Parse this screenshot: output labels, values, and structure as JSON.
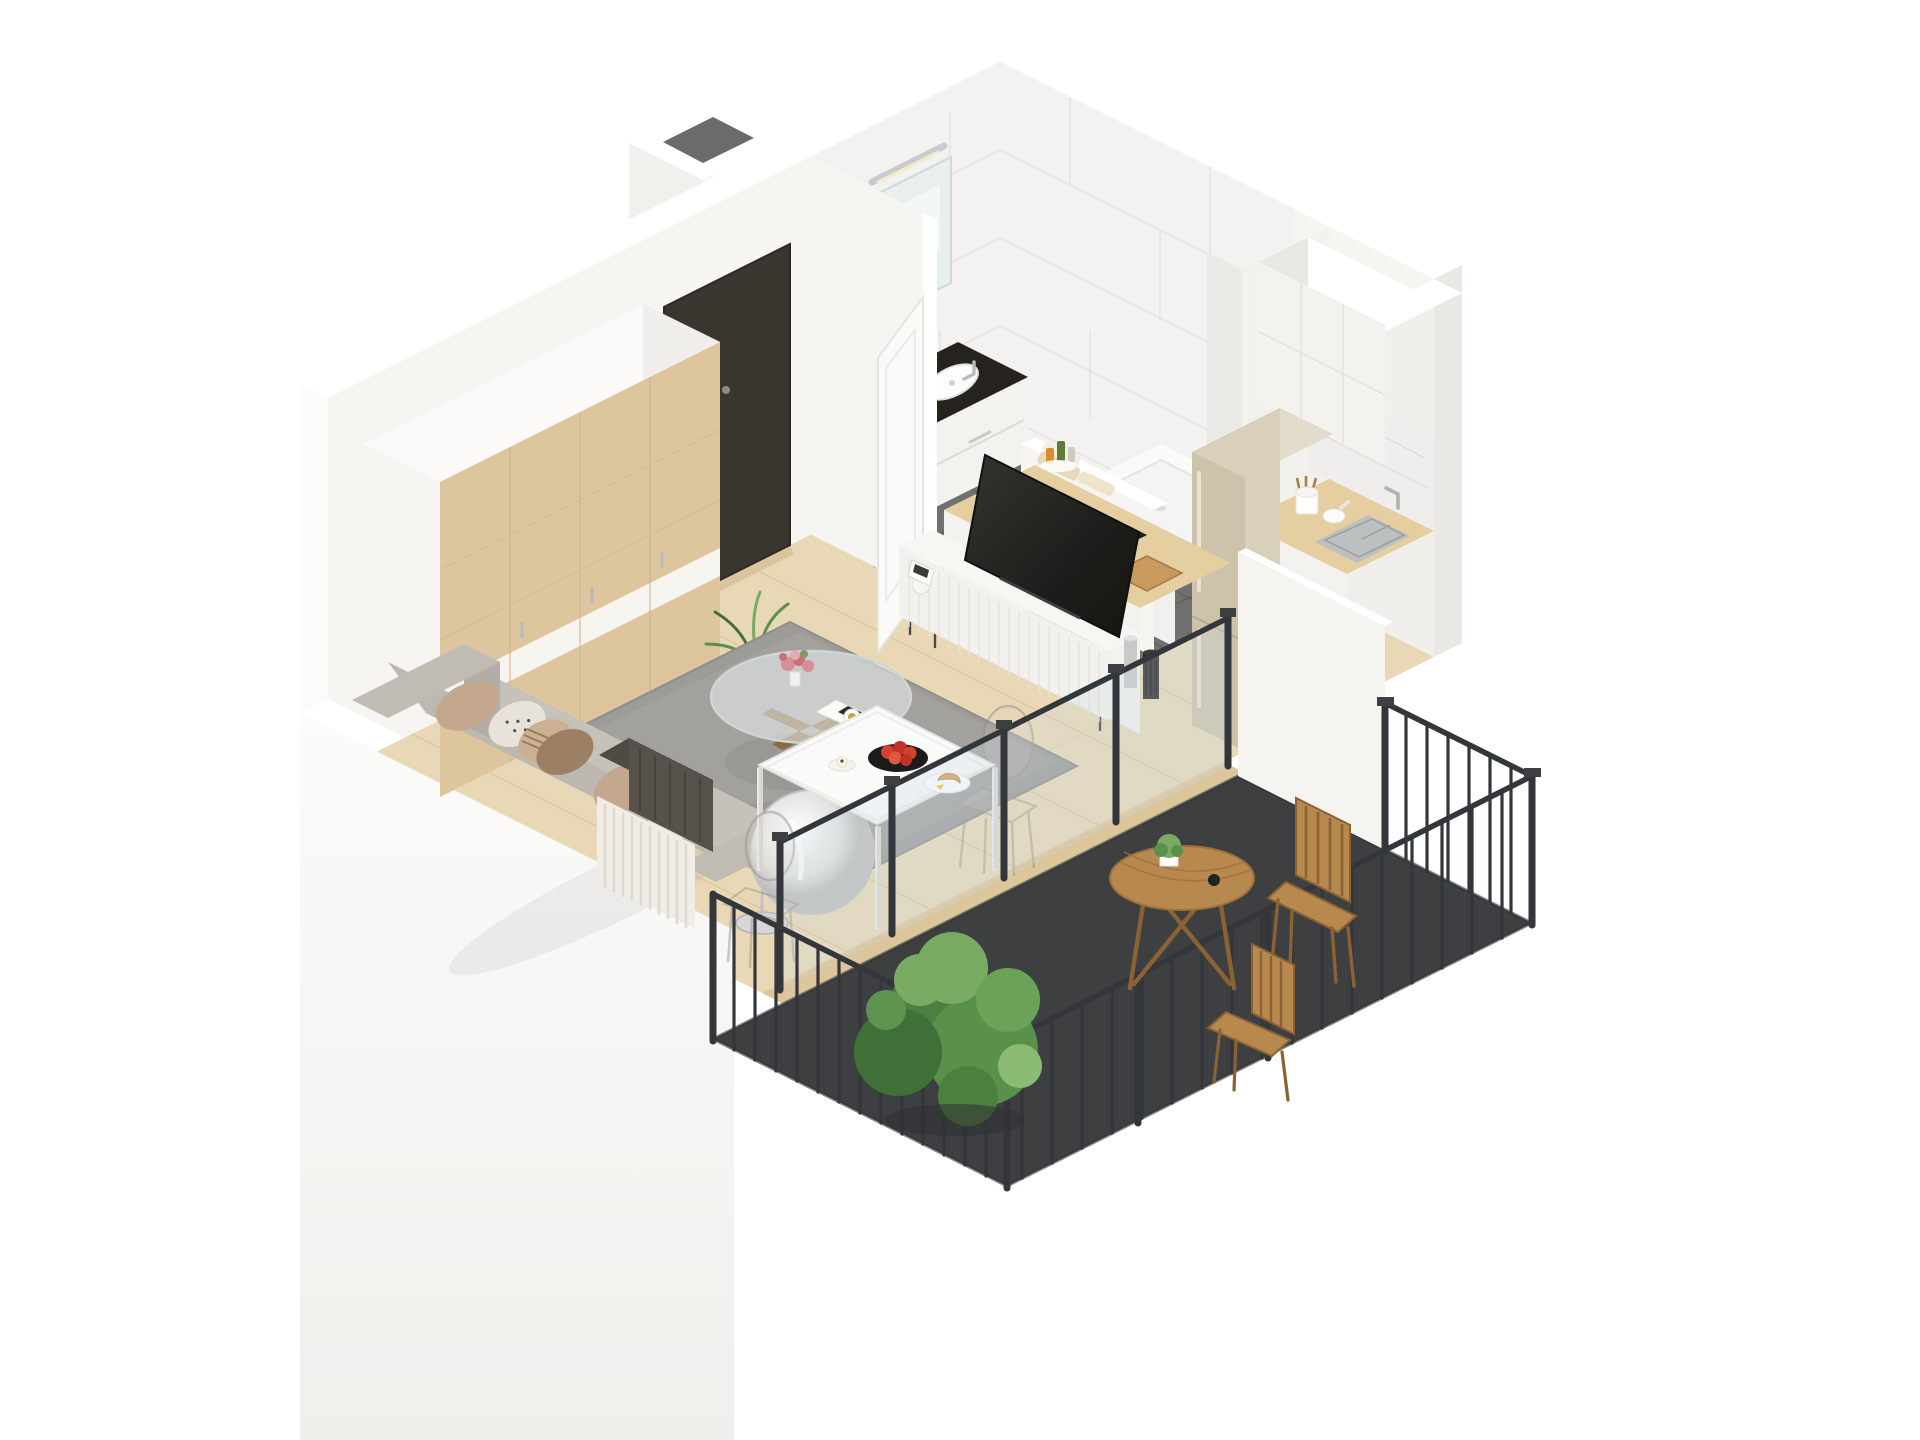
{
  "scene_type": "isometric-3d-floorplan-render",
  "colors": {
    "bg": "#ffffff",
    "wall": "#f6f5f2",
    "wall_bright": "#fbfbfa",
    "wall_shade": "#eae8e4",
    "wall_cap": "#ffffff",
    "floor_wood": "#e9d8b6",
    "floor_wood_seam": "#d9c59f",
    "bath_floor": "#707070",
    "bath_floor_line": "#5e5e5c",
    "marble": "#f3f2f0",
    "marble_line": "#e1e0dd",
    "door_dark": "#3b3530",
    "wardrobe_wood": "#ddc69e",
    "sofa_grey": "#b7b3ab",
    "sofa_seat": "#c6c2ba",
    "sofa_back": "#bdb8b0",
    "rug": "#9c9b98",
    "rug_inner": "#a6a5a2",
    "counter_wood": "#e5cfa0",
    "cabinet_white": "#f3f2ef",
    "cabinet_shade": "#e9e7e2",
    "cooktop": "#1e1e1e",
    "oven_steel": "#9a9c9d",
    "fridge_steel": "#cdc3ab",
    "sink_steel": "#bcc0c1",
    "tub_white": "#fafaf9",
    "balcony_floor": "#3e3f41",
    "railing": "#33363a",
    "glass": "#ccdce2",
    "plant_green": "#59904a",
    "plant_dark": "#3f7038",
    "plant_light": "#79ab63",
    "outdoor_wood": "#b8894e",
    "tv_black": "#22231f",
    "pillow_beige": "#c3a78f",
    "pillow_brown": "#9c8066",
    "throw_dark": "#56524b",
    "lamp_silver": "#d6d6d6",
    "coat_dark": "#3a3836",
    "fruit_red": "#d2402f",
    "croissant": "#d7a158",
    "flower_pink": "#d58f97",
    "towel_beige": "#e8d9ba"
  },
  "rooms": {
    "bathroom": {
      "objects": [
        "marble-tile-walls",
        "grey-tile-floor",
        "bathtub",
        "bath-faucet",
        "toiletry-bottles",
        "towels",
        "vanity-cabinet",
        "vanity-basin",
        "mirror",
        "wall-light",
        "half-wall"
      ]
    },
    "hallway": {
      "objects": [
        "entrance-door",
        "door-handle",
        "door-threshold",
        "coat-rail",
        "coat",
        "radiator-panel",
        "vent-shaft"
      ]
    },
    "living_room": {
      "objects": [
        "wardrobe",
        "potted-palm",
        "sofa",
        "cushions",
        "throw-blanket",
        "area-rug",
        "coffee-table",
        "flower-bouquet",
        "magazine",
        "coffee-cup",
        "floor-lamp",
        "tv-cabinet",
        "tv",
        "decor-vases",
        "radiator",
        "bathroom-door-open"
      ]
    },
    "kitchen": {
      "objects": [
        "peninsula-counter",
        "induction-cooktop",
        "oven",
        "cutting-board",
        "spice-bottles",
        "sink-counter",
        "sink",
        "faucet",
        "utensil-crock",
        "mortar",
        "counter-plant",
        "marble-backsplash",
        "upper-cabinets",
        "fridge-freezer"
      ]
    },
    "dining_area": {
      "objects": [
        "dining-table",
        "fruit-bowl",
        "red-fruits",
        "breakfast-plate",
        "croissant",
        "candle",
        "ghost-chair-near",
        "ghost-chair-far"
      ]
    },
    "balcony": {
      "objects": [
        "glass-balustrade",
        "privacy-screen-wall",
        "metal-railing",
        "dark-outdoor-floor",
        "round-wood-table",
        "potted-herbs",
        "folding-chair-back",
        "folding-chair-side",
        "large-shrub"
      ]
    }
  }
}
